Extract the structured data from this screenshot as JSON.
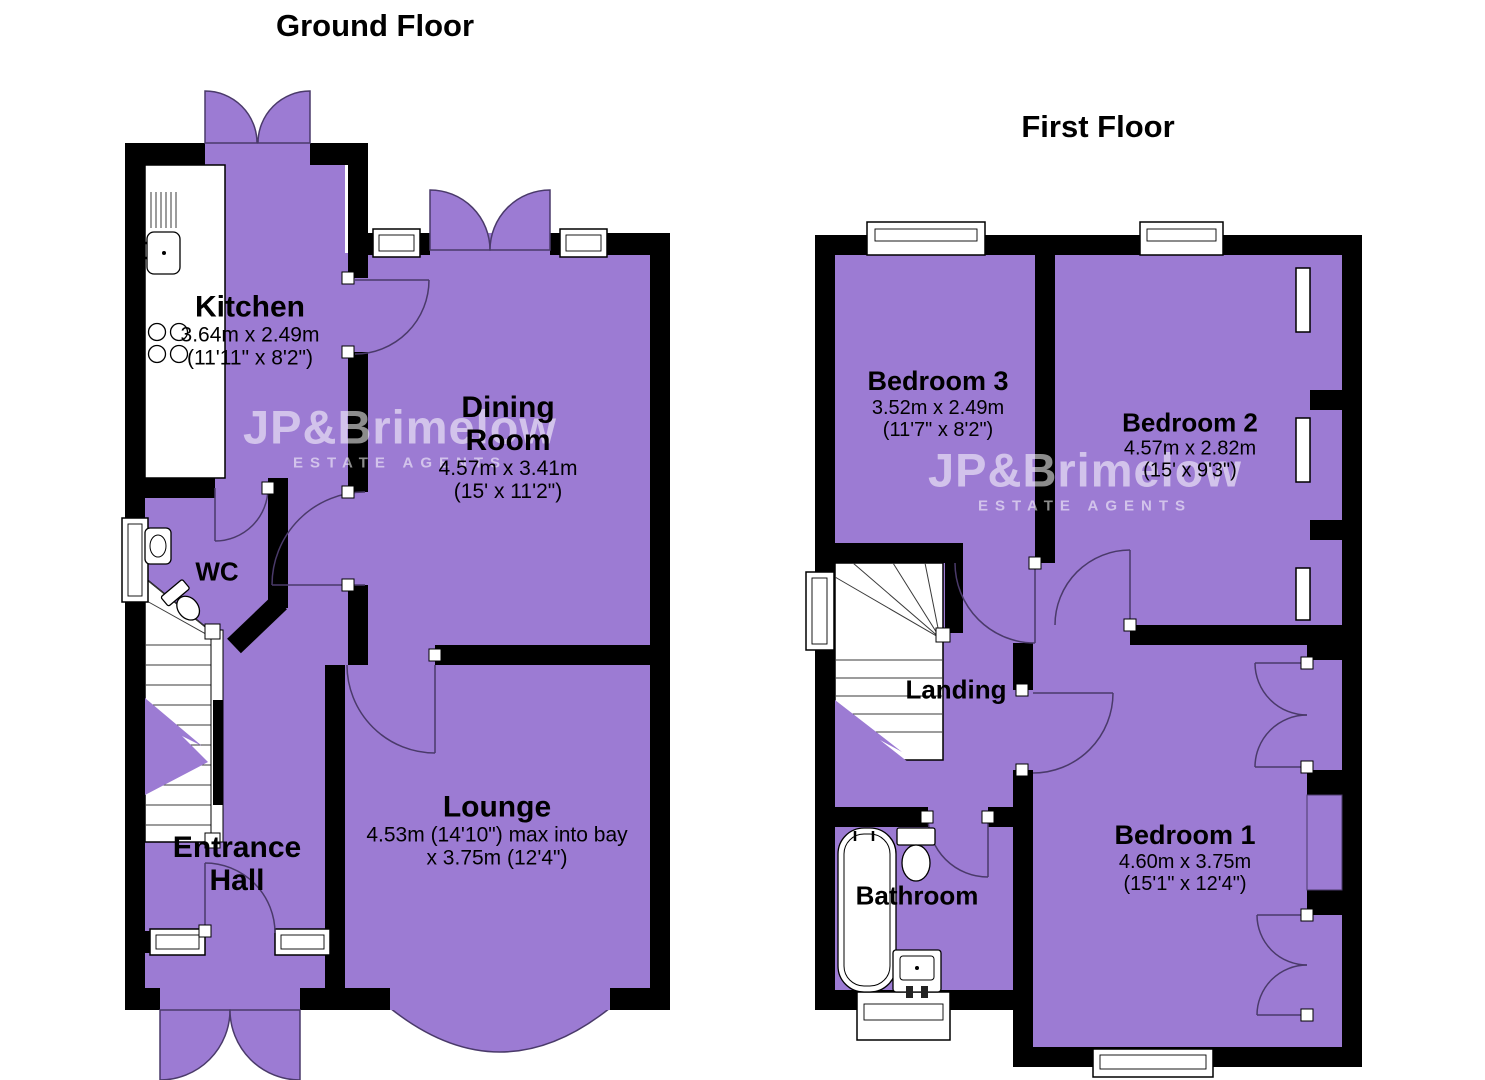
{
  "watermark": {
    "line1": "JP&Brimelow",
    "line2": "ESTATE AGENTS"
  },
  "colors": {
    "room_fill": "#9c7bd3",
    "wall": "#000000",
    "door_arc": "#4a3a6a",
    "background": "#ffffff",
    "watermark": "rgba(255,255,255,0.55)"
  },
  "ground_floor": {
    "title": "Ground Floor",
    "rooms": {
      "kitchen": {
        "name": "Kitchen",
        "metric": "3.64m x 2.49m",
        "imperial": "(11'11\" x 8'2\")"
      },
      "dining_room": {
        "name_line1": "Dining",
        "name_line2": "Room",
        "metric": "4.57m x 3.41m",
        "imperial": "(15' x 11'2\")"
      },
      "wc": {
        "name": "WC"
      },
      "entrance_hall": {
        "name_line1": "Entrance",
        "name_line2": "Hall"
      },
      "lounge": {
        "name": "Lounge",
        "metric": "4.53m (14'10\") max into bay",
        "imperial": "x 3.75m (12'4\")"
      }
    }
  },
  "first_floor": {
    "title": "First Floor",
    "rooms": {
      "bedroom3": {
        "name": "Bedroom 3",
        "metric": "3.52m x 2.49m",
        "imperial": "(11'7\" x 8'2\")"
      },
      "bedroom2": {
        "name": "Bedroom 2",
        "metric": "4.57m x 2.82m",
        "imperial": "(15' x 9'3\")"
      },
      "landing": {
        "name": "Landing"
      },
      "bathroom": {
        "name": "Bathroom"
      },
      "bedroom1": {
        "name": "Bedroom 1",
        "metric": "4.60m x 3.75m",
        "imperial": "(15'1\" x 12'4\")"
      }
    }
  }
}
